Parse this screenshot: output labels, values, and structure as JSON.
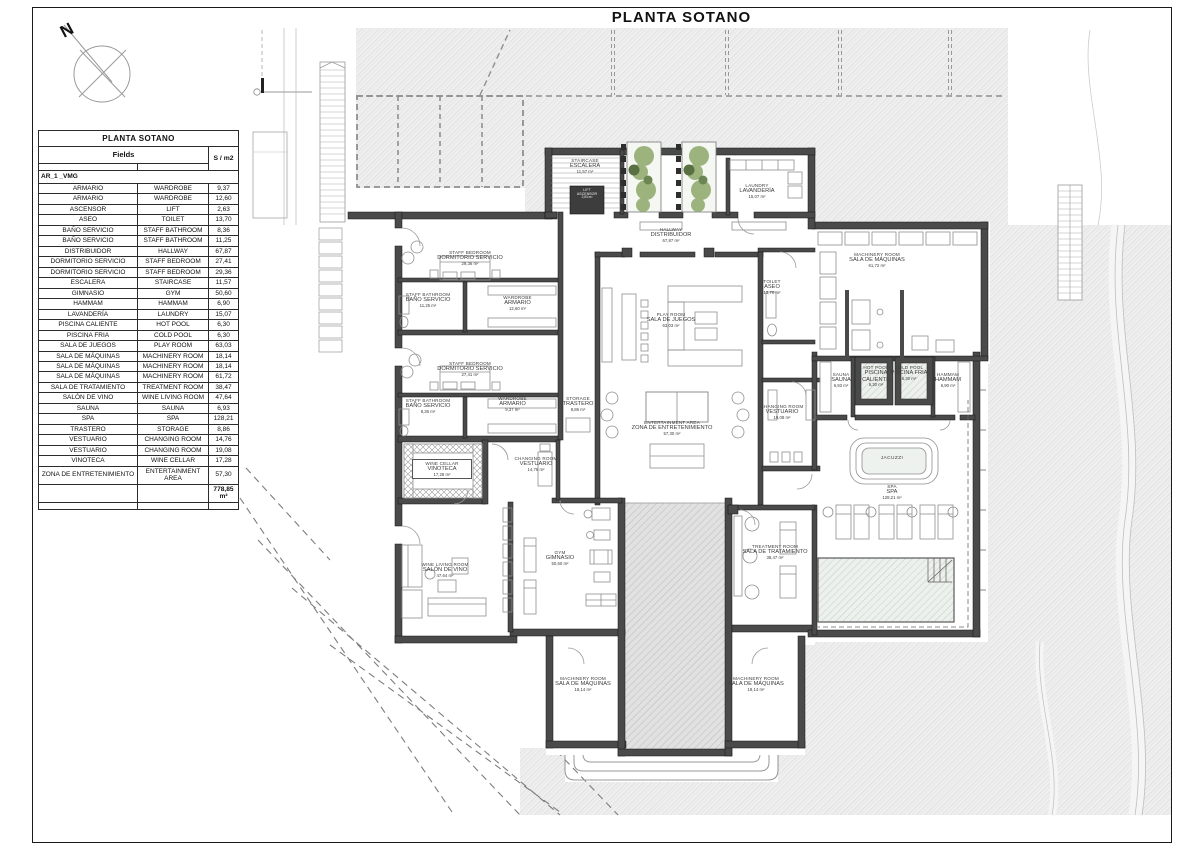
{
  "page": {
    "title": "PLANTA SOTANO"
  },
  "compass": {
    "north_label": "N"
  },
  "legend": {
    "title": "PLANTA SOTANO",
    "fields_header": "Fields",
    "area_header": "S / m2",
    "group_label": "AR_1 _VMG",
    "rows": [
      {
        "es": "ARMARIO",
        "en": "WARDROBE",
        "m2": "9,37"
      },
      {
        "es": "ARMARIO",
        "en": "WARDROBE",
        "m2": "12,60"
      },
      {
        "es": "ASCENSOR",
        "en": "LIFT",
        "m2": "2,63"
      },
      {
        "es": "ASEO",
        "en": "TOILET",
        "m2": "13,70"
      },
      {
        "es": "BAÑO SERVICIO",
        "en": "STAFF BATHROOM",
        "m2": "8,36"
      },
      {
        "es": "BAÑO SERVICIO",
        "en": "STAFF BATHROOM",
        "m2": "11,25"
      },
      {
        "es": "DISTRIBUIDOR",
        "en": "HALLWAY",
        "m2": "67,87"
      },
      {
        "es": "DORMITORIO SERVICIO",
        "en": "STAFF BEDROOM",
        "m2": "27,41"
      },
      {
        "es": "DORMITORIO SERVICIO",
        "en": "STAFF BEDROOM",
        "m2": "29,36"
      },
      {
        "es": "ESCALERA",
        "en": "STAIRCASE",
        "m2": "11,57"
      },
      {
        "es": "GIMNASIO",
        "en": "GYM",
        "m2": "50,60"
      },
      {
        "es": "HAMMAM",
        "en": "HAMMAM",
        "m2": "6,90"
      },
      {
        "es": "LAVANDERÍA",
        "en": "LAUNDRY",
        "m2": "15,07"
      },
      {
        "es": "PISCINA CALIENTE",
        "en": "HOT POOL",
        "m2": "6,30"
      },
      {
        "es": "PISCINA FRIA",
        "en": "COLD POOL",
        "m2": "6,30"
      },
      {
        "es": "SALA DE JUEGOS",
        "en": "PLAY ROOM",
        "m2": "63,03"
      },
      {
        "es": "SALA DE MÁQUINAS",
        "en": "MACHINERY ROOM",
        "m2": "18,14"
      },
      {
        "es": "SALA DE MÁQUINAS",
        "en": "MACHINERY ROOM",
        "m2": "18,14"
      },
      {
        "es": "SALA DE MÁQUINAS",
        "en": "MACHINERY ROOM",
        "m2": "61,72"
      },
      {
        "es": "SALA DE TRATAMIENTO",
        "en": "TREATMENT ROOM",
        "m2": "38,47"
      },
      {
        "es": "SALÓN DE VINO",
        "en": "WINE LIVING ROOM",
        "m2": "47,64"
      },
      {
        "es": "SAUNA",
        "en": "SAUNA",
        "m2": "6,93"
      },
      {
        "es": "SPA",
        "en": "SPA",
        "m2": "128,21"
      },
      {
        "es": "TRASTERO",
        "en": "STORAGE",
        "m2": "8,86"
      },
      {
        "es": "VESTUARIO",
        "en": "CHANGING ROOM",
        "m2": "14,76"
      },
      {
        "es": "VESTUARIO",
        "en": "CHANGING ROOM",
        "m2": "19,08"
      },
      {
        "es": "VINOTECA",
        "en": "WINE CELLAR",
        "m2": "17,28"
      },
      {
        "es": "ZONA DE ENTRETENIMIENTO",
        "en": "ENTERTAINMENT AREA",
        "m2": "57,30"
      }
    ],
    "total": "778,85 m²"
  },
  "plan": {
    "rooms": [
      {
        "en": "STAIRCASE",
        "es": "ESCALERA",
        "m2": "11,57 m²",
        "x": 554,
        "y": 158,
        "w": 62
      },
      {
        "en": "LIFT",
        "es": "ASCENSOR",
        "m2": "2,63 m²",
        "x": 569,
        "y": 189,
        "w": 36,
        "cls": "on-dark"
      },
      {
        "en": "LAUNDRY",
        "es": "LAVANDERÍA",
        "m2": "15,07 m²",
        "x": 725,
        "y": 183,
        "w": 64
      },
      {
        "en": "HALLWAY",
        "es": "DISTRIBUIDOR",
        "m2": "67,87 m²",
        "x": 631,
        "y": 227,
        "w": 80
      },
      {
        "en": "STAFF BEDROOM",
        "es": "DORMITORIO SERVICIO",
        "m2": "29,36 m²",
        "x": 422,
        "y": 250,
        "w": 96
      },
      {
        "en": "STAFF BATHROOM",
        "es": "BAÑO SERVICIO",
        "m2": "11,25 m²",
        "x": 397,
        "y": 292,
        "w": 62
      },
      {
        "en": "WARDROBE",
        "es": "ARMARIO",
        "m2": "12,60 m²",
        "x": 490,
        "y": 295,
        "w": 55
      },
      {
        "en": "STAFF BEDROOM",
        "es": "DORMITORIO SERVICIO",
        "m2": "27,41 m²",
        "x": 422,
        "y": 361,
        "w": 96
      },
      {
        "en": "STAFF BATHROOM",
        "es": "BAÑO SERVICIO",
        "m2": "8,36 m²",
        "x": 397,
        "y": 398,
        "w": 62
      },
      {
        "en": "WARDROBE",
        "es": "ARMARIO",
        "m2": "9,37 m²",
        "x": 485,
        "y": 396,
        "w": 55
      },
      {
        "en": "STORAGE",
        "es": "TRASTERO",
        "m2": "8,86 m²",
        "x": 553,
        "y": 396,
        "w": 50
      },
      {
        "en": "PLAY ROOM",
        "es": "SALA DE JUEGOS",
        "m2": "63,03 m²",
        "x": 631,
        "y": 312,
        "w": 80
      },
      {
        "en": "MACHINERY ROOM",
        "es": "SALA DE MÁQUINAS",
        "m2": "61,72 m²",
        "x": 832,
        "y": 252,
        "w": 90
      },
      {
        "en": "TOILET",
        "es": "ASEO",
        "m2": "13,70 m²",
        "x": 752,
        "y": 279,
        "w": 40
      },
      {
        "en": "SAUNA",
        "es": "SAUNA",
        "m2": "6,93 m²",
        "x": 824,
        "y": 372,
        "w": 34
      },
      {
        "en": "HOT POOL",
        "es": "PISCINA CALIENTE",
        "m2": "6,30 m²",
        "x": 853,
        "y": 365,
        "w": 46
      },
      {
        "en": "COLD POOL",
        "es": "PISCINA FRIA",
        "m2": "6,30 m²",
        "x": 887,
        "y": 365,
        "w": 44
      },
      {
        "en": "HAMMAM",
        "es": "HAMMAM",
        "m2": "6,90 m²",
        "x": 928,
        "y": 372,
        "w": 40
      },
      {
        "en": "CHANGING ROOM",
        "es": "VESTUARIO",
        "m2": "19,08 m²",
        "x": 756,
        "y": 404,
        "w": 52
      },
      {
        "en": "ENTERTAINMENT AREA",
        "es": "ZONA DE ENTRETENIMIENTO",
        "m2": "57,30 m²",
        "x": 615,
        "y": 420,
        "w": 114
      },
      {
        "en": "JACUZZI",
        "es": "",
        "m2": "",
        "x": 868,
        "y": 456,
        "w": 48,
        "cls": "single"
      },
      {
        "en": "SPA",
        "es": "SPA",
        "m2": "128,21 m²",
        "x": 867,
        "y": 484,
        "w": 50
      },
      {
        "en": "WINE CELLAR",
        "es": "VINOTECA",
        "m2": "17,28 m²",
        "x": 412,
        "y": 459,
        "w": 58,
        "cls": "boxed"
      },
      {
        "en": "CHANGING ROOM",
        "es": "VESTUARIO",
        "m2": "14,76 m²",
        "x": 508,
        "y": 456,
        "w": 56
      },
      {
        "en": "WINE LIVING ROOM",
        "es": "SALÓN DE VINO",
        "m2": "47,64 m²",
        "x": 408,
        "y": 562,
        "w": 74
      },
      {
        "en": "GYM",
        "es": "GIMNASIO",
        "m2": "50,60 m²",
        "x": 534,
        "y": 550,
        "w": 52
      },
      {
        "en": "TREATMENT ROOM",
        "es": "SALA DE TRATAMIENTO",
        "m2": "38,47 m²",
        "x": 730,
        "y": 544,
        "w": 90
      },
      {
        "en": "MACHINERY ROOM",
        "es": "SALA DE MÁQUINAS",
        "m2": "18,14 m²",
        "x": 548,
        "y": 676,
        "w": 70
      },
      {
        "en": "MACHINERY ROOM",
        "es": "SALA DE MÁQUINAS",
        "m2": "18,14 m²",
        "x": 721,
        "y": 676,
        "w": 70
      }
    ]
  }
}
